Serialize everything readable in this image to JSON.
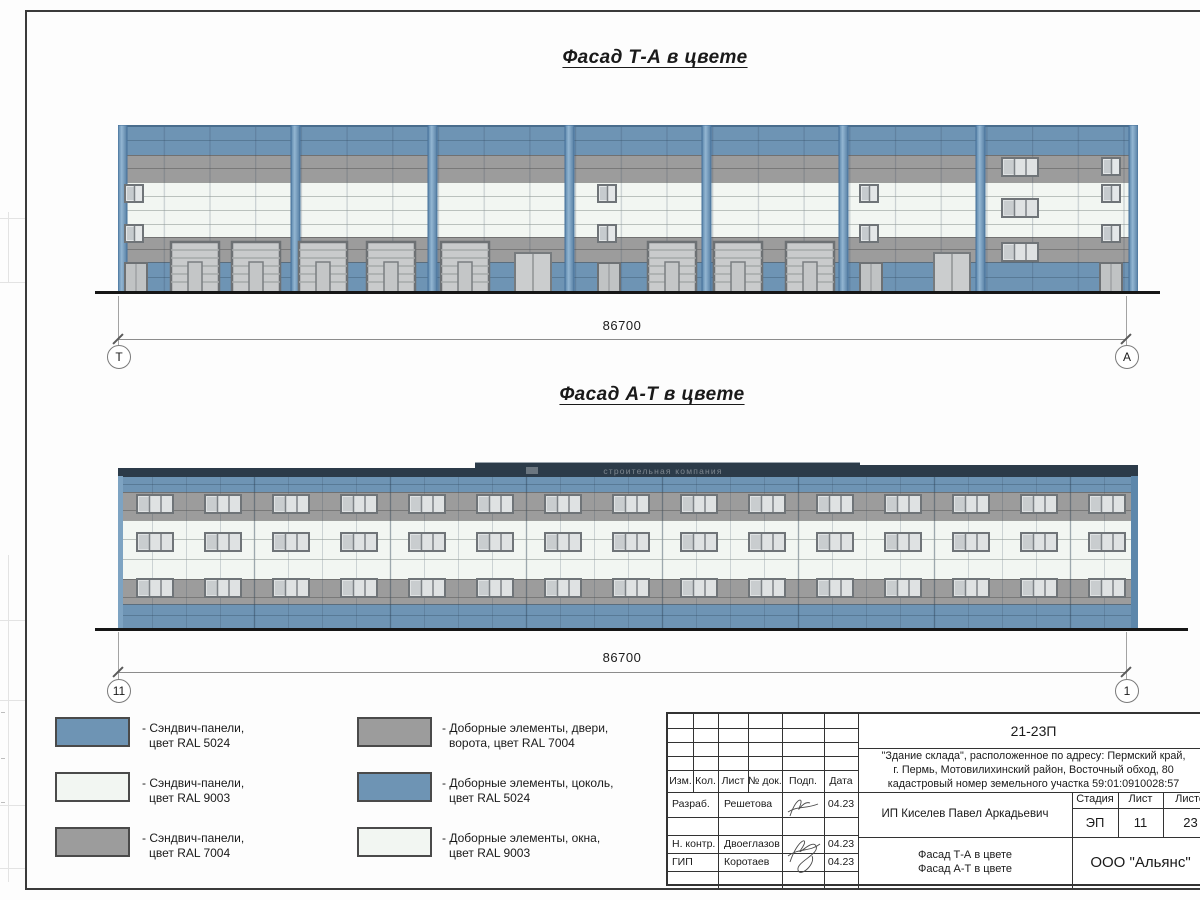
{
  "sheet": {
    "titles": {
      "facade_ta": "Фасад Т-А в цвете",
      "facade_at": "Фасад А-Т в цвете"
    },
    "watermark": "строительная компания"
  },
  "dimensions": {
    "facade_ta": {
      "length": "86700",
      "axis_left": "Т",
      "axis_right": "А"
    },
    "facade_at": {
      "length": "86700",
      "axis_left": "11",
      "axis_right": "1"
    }
  },
  "colors": {
    "panel_blue": "#6e94b4",
    "panel_white": "#f2f6f2",
    "panel_gray": "#9c9c9c",
    "parapet_dark": "#2c3b49"
  },
  "legend": {
    "items": [
      {
        "color": "#6e94b4",
        "line1": "- Сэндвич-панели,",
        "line2": "цвет RAL 5024"
      },
      {
        "color": "#f2f6f2",
        "line1": "- Сэндвич-панели,",
        "line2": "цвет RAL 9003"
      },
      {
        "color": "#9c9c9c",
        "line1": "- Сэндвич-панели,",
        "line2": "цвет RAL 7004"
      },
      {
        "color": "#9c9c9c",
        "line1": "- Доборные элементы, двери,",
        "line2": "ворота, цвет RAL 7004"
      },
      {
        "color": "#6e94b4",
        "line1": "- Доборные элементы, цоколь,",
        "line2": "цвет RAL 5024"
      },
      {
        "color": "#f2f6f2",
        "line1": "- Доборные элементы, окна,",
        "line2": "цвет RAL 9003"
      }
    ]
  },
  "titleblock": {
    "doc_number": "21-23П",
    "project_description": "\"Здание склада\", расположенное по адресу: Пермский край,\nг. Пермь, Мотовилихинский район, Восточный обход, 80\nкадастровый номер земельного участка 59:01:0910028:57",
    "columns": [
      "Изм.",
      "Кол.",
      "Лист",
      "№ док.",
      "Подп.",
      "Дата"
    ],
    "rows": [
      {
        "role": "Разраб.",
        "name": "Решетова",
        "date": "04.23"
      },
      {
        "role": "Н. контр.",
        "name": "Двоеглазов",
        "date": "04.23"
      },
      {
        "role": "ГИП",
        "name": "Коротаев",
        "date": "04.23"
      }
    ],
    "client": "ИП Киселев Павел Аркадьевич",
    "stage_label": "Стадия",
    "sheet_label": "Лист",
    "sheets_label": "Листов",
    "stage": "ЭП",
    "sheet_number": "11",
    "sheets_total": "23",
    "sheet_title": "Фасад Т-А в цвете\nФасад А-Т в цвете",
    "organization": "ООО \"Альянс\""
  }
}
